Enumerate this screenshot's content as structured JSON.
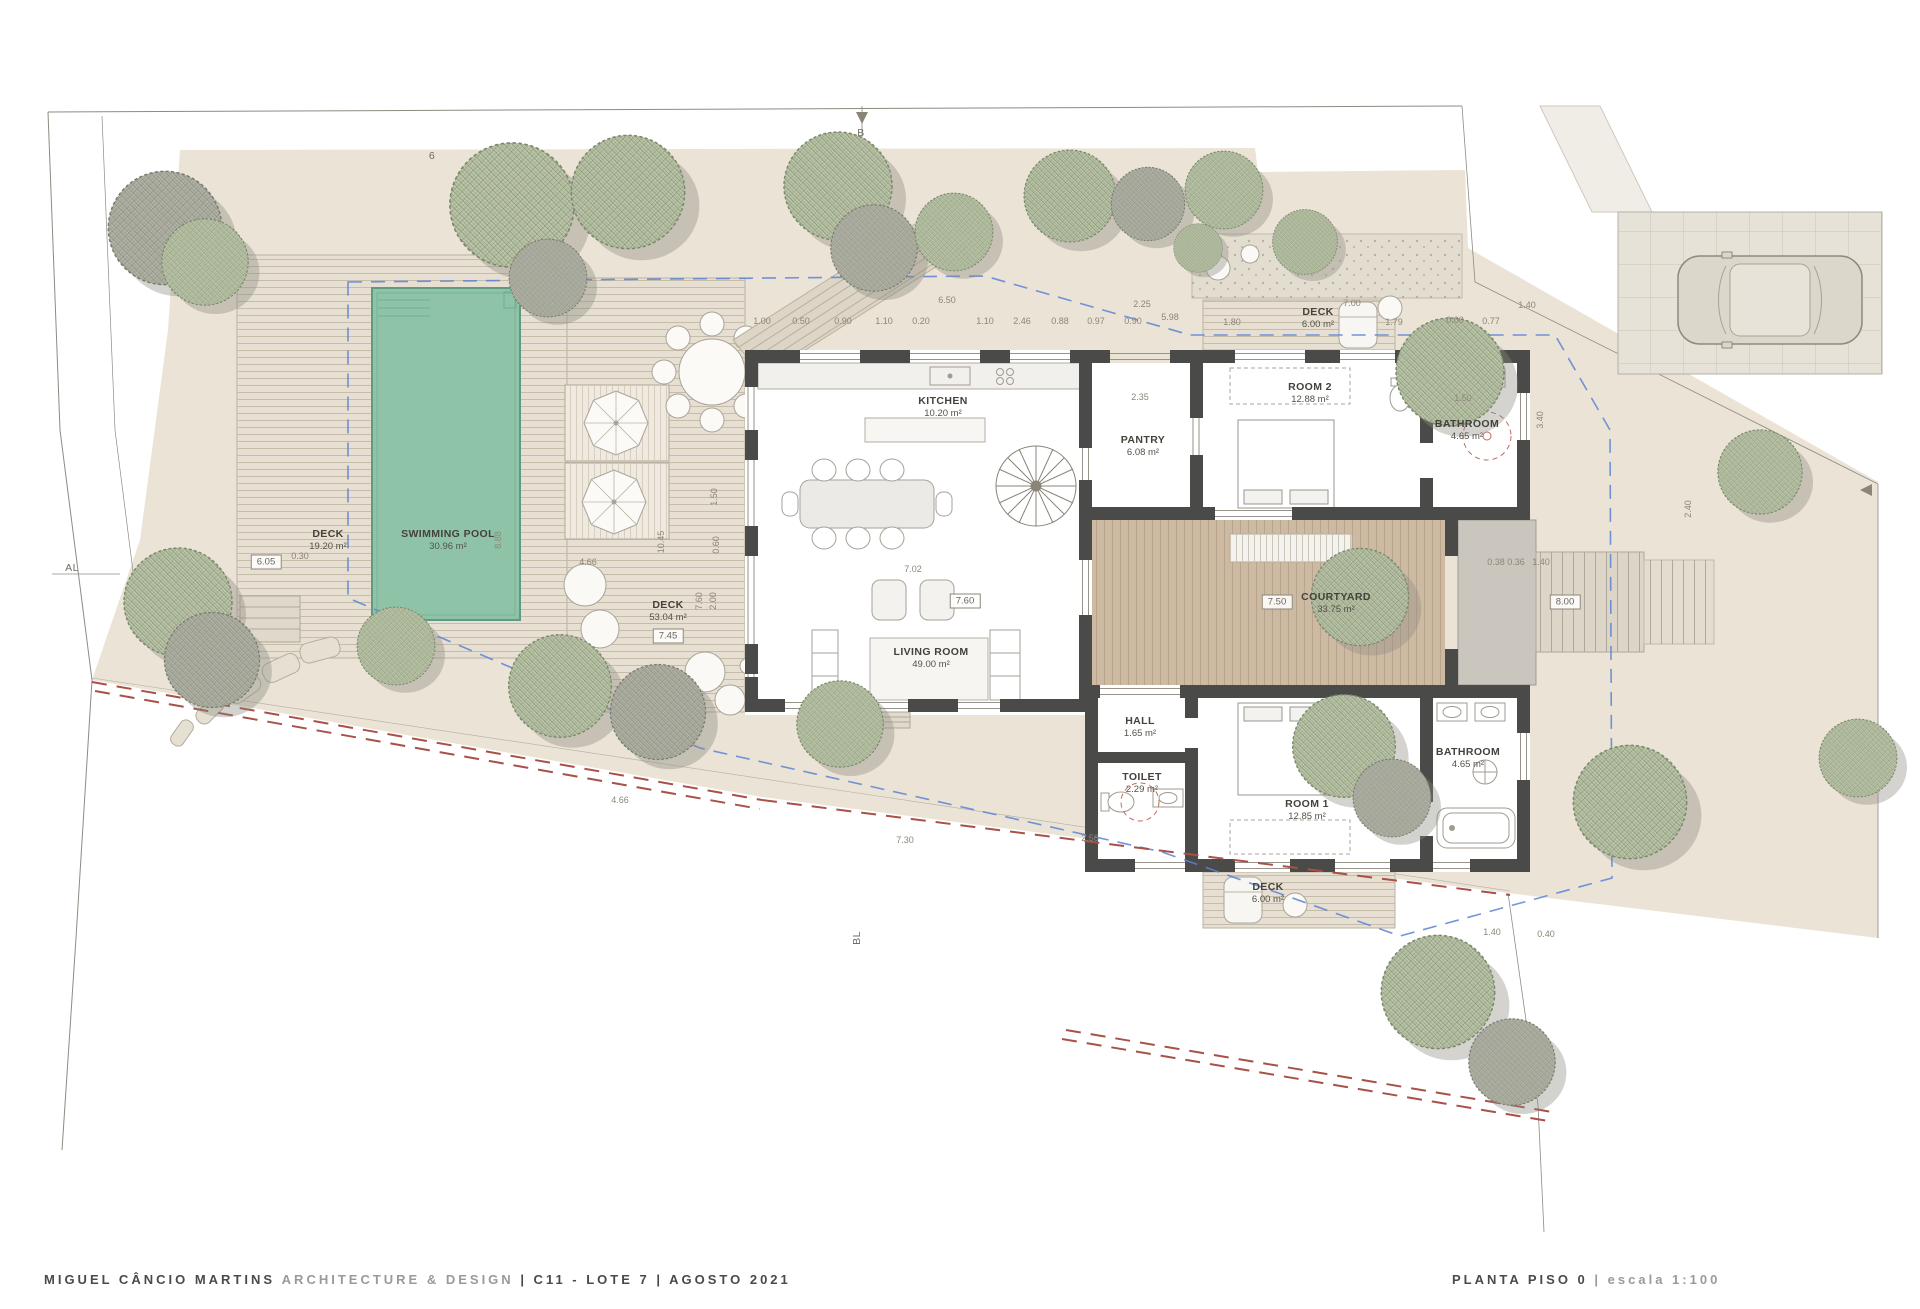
{
  "titlebar": {
    "firm": "MIGUEL CÂNCIO MARTINS",
    "dept": "ARCHITECTURE & DESIGN",
    "project": "| C11 - LOTE 7 | AGOSTO 2021",
    "sheet_name": "PLANTA PISO 0",
    "sheet_scale": "| escala 1:100"
  },
  "colors": {
    "wall": "#4a4a48",
    "site": "#eae3d6",
    "pool": "#8fc3a8",
    "deck": "#e6dfd2",
    "courtyard": "#cdbaa3",
    "tree_green": "#bcc5ab",
    "setback_blue": "#5b82d6",
    "boundary_red": "#a85148"
  },
  "rooms": [
    {
      "slug": "deck-pool",
      "name": "DECK",
      "area": "19.20 m²",
      "x": 328,
      "y": 540
    },
    {
      "slug": "swimming-pool",
      "name": "SWIMMING POOL",
      "area": "30.96 m²",
      "x": 448,
      "y": 540
    },
    {
      "slug": "deck-living",
      "name": "DECK",
      "area": "53.04 m²",
      "x": 668,
      "y": 611
    },
    {
      "slug": "kitchen",
      "name": "KITCHEN",
      "area": "10.20 m²",
      "x": 943,
      "y": 407
    },
    {
      "slug": "pantry",
      "name": "PANTRY",
      "area": "6.08 m²",
      "x": 1143,
      "y": 446
    },
    {
      "slug": "living-room",
      "name": "LIVING ROOM",
      "area": "49.00 m²",
      "x": 931,
      "y": 658
    },
    {
      "slug": "deck-top",
      "name": "DECK",
      "area": "6.00 m²",
      "x": 1318,
      "y": 318
    },
    {
      "slug": "room-2",
      "name": "ROOM 2",
      "area": "12.88 m²",
      "x": 1310,
      "y": 393
    },
    {
      "slug": "bathroom-top",
      "name": "BATHROOM",
      "area": "4.65 m²",
      "x": 1467,
      "y": 430
    },
    {
      "slug": "courtyard",
      "name": "COURTYARD",
      "area": "33.75 m²",
      "x": 1336,
      "y": 603
    },
    {
      "slug": "hall",
      "name": "HALL",
      "area": "1.65 m²",
      "x": 1140,
      "y": 727
    },
    {
      "slug": "toilet",
      "name": "TOILET",
      "area": "2.29 m²",
      "x": 1142,
      "y": 783
    },
    {
      "slug": "room-1",
      "name": "ROOM 1",
      "area": "12.85 m²",
      "x": 1307,
      "y": 810
    },
    {
      "slug": "bathroom-bottom",
      "name": "BATHROOM",
      "area": "4.65 m²",
      "x": 1468,
      "y": 758
    },
    {
      "slug": "deck-bottom",
      "name": "DECK",
      "area": "6.00 m²",
      "x": 1268,
      "y": 893
    }
  ],
  "boxed_dims": [
    {
      "t": "6.05",
      "x": 266,
      "y": 562
    },
    {
      "t": "7.45",
      "x": 668,
      "y": 636
    },
    {
      "t": "7.60",
      "x": 965,
      "y": 601
    },
    {
      "t": "7.50",
      "x": 1277,
      "y": 602
    },
    {
      "t": "8.00",
      "x": 1565,
      "y": 602
    }
  ],
  "dims": [
    {
      "t": "1.00",
      "x": 762,
      "y": 321
    },
    {
      "t": "0.50",
      "x": 801,
      "y": 321
    },
    {
      "t": "0.90",
      "x": 843,
      "y": 321
    },
    {
      "t": "1.10",
      "x": 884,
      "y": 321
    },
    {
      "t": "0.20",
      "x": 921,
      "y": 321
    },
    {
      "t": "6.50",
      "x": 947,
      "y": 300
    },
    {
      "t": "1.10",
      "x": 985,
      "y": 321
    },
    {
      "t": "2.46",
      "x": 1022,
      "y": 321
    },
    {
      "t": "0.88",
      "x": 1060,
      "y": 321
    },
    {
      "t": "0.97",
      "x": 1096,
      "y": 321
    },
    {
      "t": "0.90",
      "x": 1133,
      "y": 321
    },
    {
      "t": "5.98",
      "x": 1170,
      "y": 317
    },
    {
      "t": "2.25",
      "x": 1142,
      "y": 304
    },
    {
      "t": "2.35",
      "x": 1140,
      "y": 397
    },
    {
      "t": "1.80",
      "x": 1232,
      "y": 322
    },
    {
      "t": "7.00",
      "x": 1352,
      "y": 303
    },
    {
      "t": "1.79",
      "x": 1394,
      "y": 322
    },
    {
      "t": "0.00",
      "x": 1455,
      "y": 320
    },
    {
      "t": "0.77",
      "x": 1491,
      "y": 321
    },
    {
      "t": "1.40",
      "x": 1527,
      "y": 305
    },
    {
      "t": "1.50",
      "x": 1463,
      "y": 398
    },
    {
      "t": "7.02",
      "x": 913,
      "y": 569
    },
    {
      "t": "1.50",
      "x": 714,
      "y": 497,
      "r": 1
    },
    {
      "t": "0.60",
      "x": 716,
      "y": 545,
      "r": 1
    },
    {
      "t": "7.60",
      "x": 699,
      "y": 601,
      "r": 1
    },
    {
      "t": "2.00",
      "x": 713,
      "y": 601,
      "r": 1
    },
    {
      "t": "10.45",
      "x": 661,
      "y": 542,
      "r": 1
    },
    {
      "t": "8.88",
      "x": 498,
      "y": 540,
      "r": 1
    },
    {
      "t": "0.30",
      "x": 300,
      "y": 556
    },
    {
      "t": "4.66",
      "x": 588,
      "y": 562
    },
    {
      "t": "4.66",
      "x": 620,
      "y": 800
    },
    {
      "t": "7.30",
      "x": 905,
      "y": 840
    },
    {
      "t": "2.56",
      "x": 1090,
      "y": 838
    },
    {
      "t": "1.40",
      "x": 1492,
      "y": 932
    },
    {
      "t": "0.40",
      "x": 1546,
      "y": 934
    },
    {
      "t": "0.38 0.36",
      "x": 1506,
      "y": 562
    },
    {
      "t": "1.40",
      "x": 1541,
      "y": 562
    },
    {
      "t": "3.40",
      "x": 1540,
      "y": 420,
      "r": 1
    },
    {
      "t": "2.40",
      "x": 1688,
      "y": 509,
      "r": 1
    },
    {
      "t": "AL",
      "x": 72,
      "y": 568,
      "m": 1
    },
    {
      "t": "B",
      "x": 861,
      "y": 133,
      "m": 1
    },
    {
      "t": "6",
      "x": 432,
      "y": 156,
      "m": 1
    },
    {
      "t": "BL",
      "x": 857,
      "y": 938,
      "r": 1,
      "m": 1
    }
  ]
}
